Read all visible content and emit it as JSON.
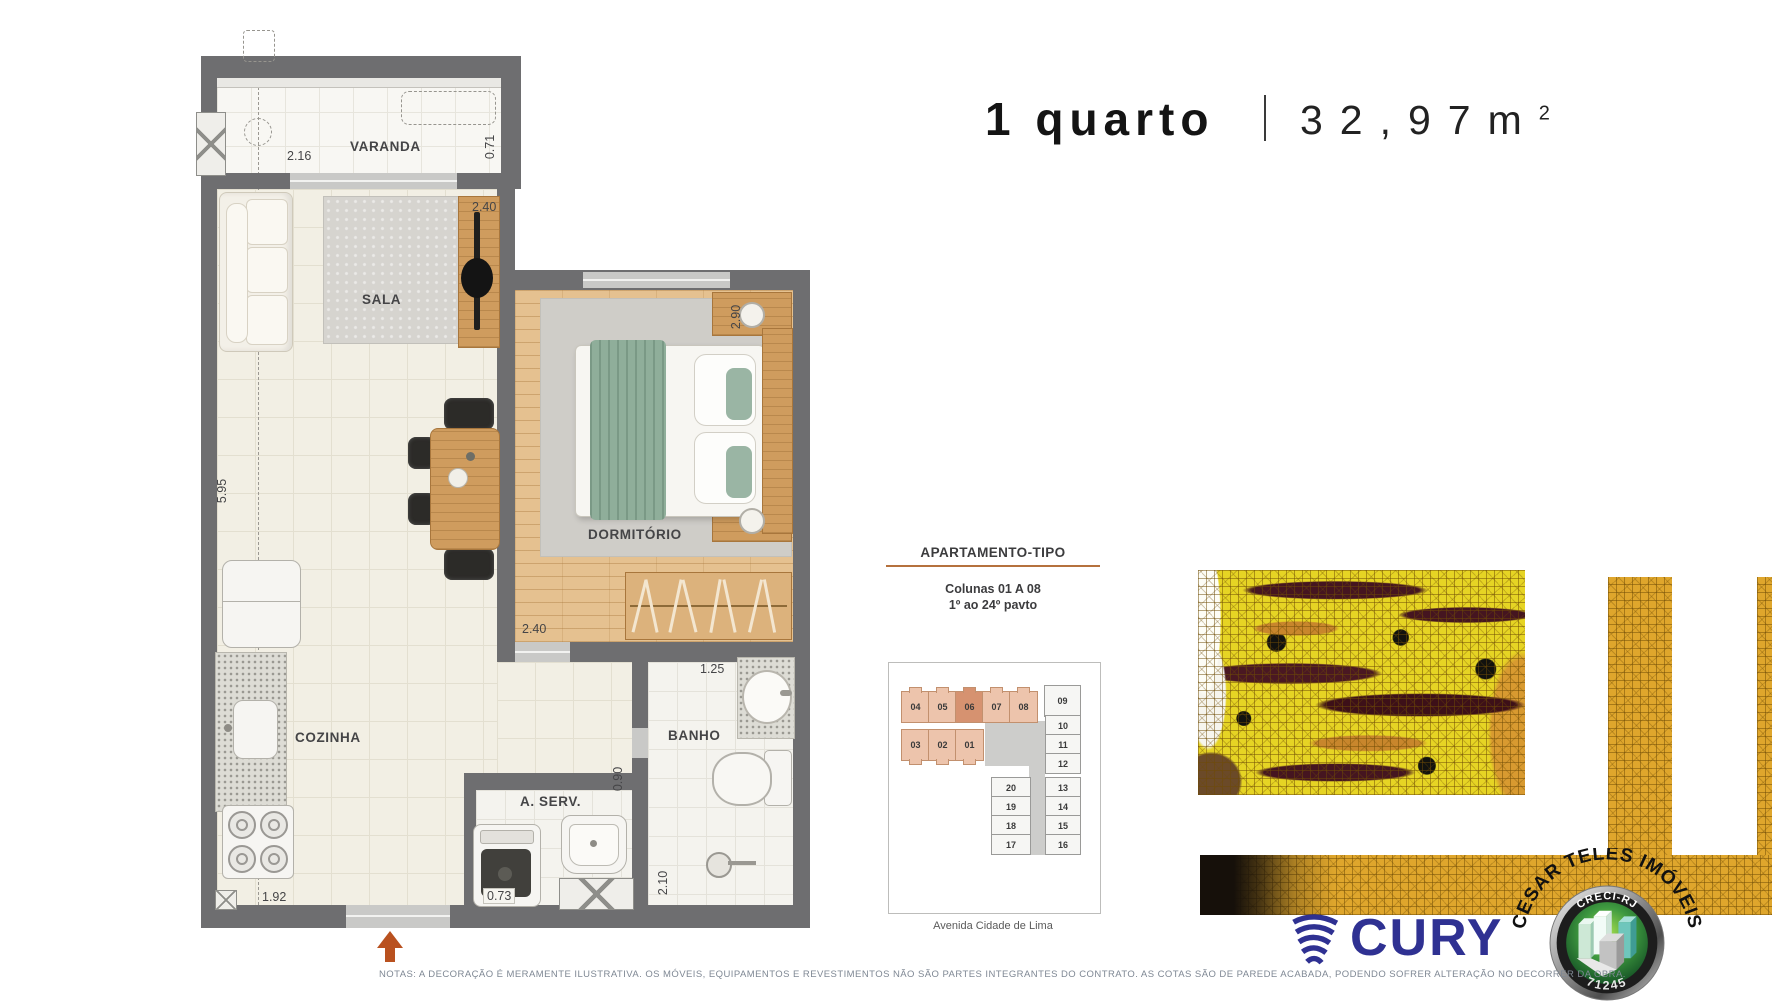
{
  "title": {
    "rooms": "1 quarto",
    "separator": "|",
    "area": "32,97m",
    "area_sup": "2"
  },
  "floorplan": {
    "rooms": {
      "varanda": {
        "label": "VARANDA",
        "dim_width": "2.16",
        "dim_depth": "0.71"
      },
      "sala": {
        "label": "SALA",
        "dim_width": "2.40"
      },
      "dormitorio": {
        "label": "DORMITÓRIO",
        "dim_depth": "2.90",
        "dim_width": "2.40"
      },
      "cozinha": {
        "label": "COZINHA",
        "dim_depth": "5.95",
        "dim_width": "1.92"
      },
      "area_servico": {
        "label": "A. SERV.",
        "dim_depth": "0.90",
        "dim_width": "0.73"
      },
      "banho": {
        "label": "BANHO",
        "dim_width": "1.25",
        "dim_depth": "2.10"
      }
    }
  },
  "apartamento_tipo": {
    "heading": "APARTAMENTO-TIPO",
    "line1": "Colunas 01 A 08",
    "line2": "1º ao 24º pavto",
    "street": "Avenida Cidade de Lima",
    "keyplan": {
      "row_top": [
        "04",
        "05",
        "06",
        "07",
        "08"
      ],
      "unit_09": "09",
      "row_mid": [
        "03",
        "02",
        "01"
      ],
      "col_right": [
        "10",
        "11",
        "12",
        "13",
        "14",
        "15",
        "16"
      ],
      "col_inner": [
        "20",
        "19",
        "18",
        "17"
      ],
      "highlighted_unit": "06"
    }
  },
  "branding": {
    "cury": "CURY",
    "seal": {
      "arc_text": "CESAR TELES IMÓVEIS",
      "creci": "CRECI-RJ",
      "number": "71245"
    }
  },
  "notes": "NOTAS: A DECORAÇÃO É MERAMENTE ILUSTRATIVA. OS MÓVEIS, EQUIPAMENTOS E REVESTIMENTOS NÃO SÃO PARTES INTEGRANTES DO CONTRATO. AS COTAS SÃO DE PAREDE ACABADA, PODENDO SOFRER ALTERAÇÃO NO DECORRER DA OBRA.",
  "colors": {
    "wall": "#6e6e70",
    "accent_arrow": "#b9511f",
    "cury_blue": "#2f3192",
    "unit_salmon": "#edc4ac",
    "unit_highlight": "#d69270",
    "mosaic_yellow": "#e6d424",
    "mosaic_gold": "#dfa62c"
  }
}
